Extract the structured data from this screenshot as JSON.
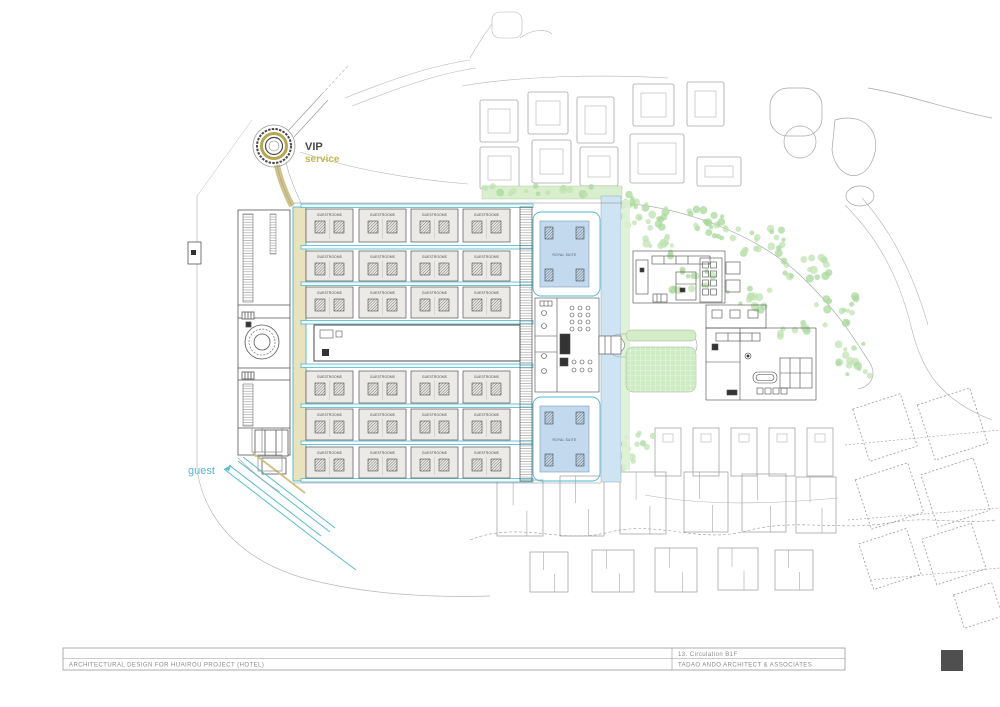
{
  "title_block": {
    "project": "ARCHITECTURAL DESIGN FOR HUAIROU PROJECT (HOTEL)",
    "sheet": "13.  Circulation B1F",
    "firm": "TADAO ANDO ARCHITECT & ASSOCIATES"
  },
  "plan_labels": {
    "vip": "VIP",
    "vip_sub": "service",
    "guest": "guest",
    "guestroom_block": "GUESTROOMS",
    "suite": "ROYAL SUITE"
  },
  "structure": {
    "guestroom_rows": 6,
    "guestroom_cols": 4,
    "suite_courts": 2
  },
  "colors": {
    "road_cyan": "#4cb9cf",
    "road_fill": "#f4fafb",
    "service_road_fill": "#e9e3bd",
    "service_road_edge": "#cfc387",
    "vip_ring_olive": "#b3a74f",
    "guest_text": "#55b9d5",
    "canal_water": "#cfe4f3",
    "suite_court": "#c3daee",
    "tree_green": "#bfe3b2",
    "tree_green_dark": "#a9d89c",
    "lawn_green": "#cdecc4",
    "green_band": "#d9eecd",
    "block_fill": "#eceae6",
    "drawing_line": "#555555",
    "context_line": "#a6a6a6",
    "titleblock_text": "#8a8a8a",
    "stamp": "#4f4f4f"
  }
}
